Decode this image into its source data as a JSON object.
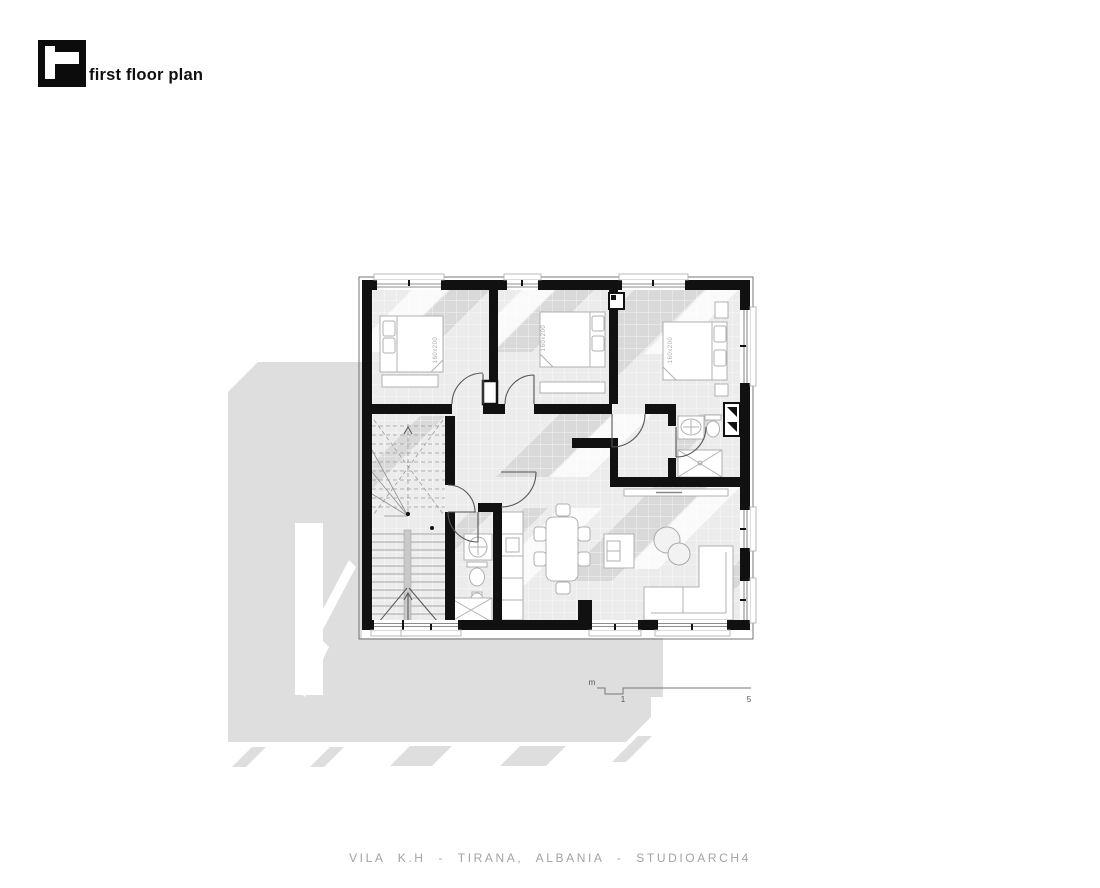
{
  "header": {
    "title": "first floor plan",
    "logo": "studioarch4-logo-icon"
  },
  "plan": {
    "bedroom1_bed_label": "160x200",
    "bedroom2_bed_label": "160x200",
    "bedroom3_bed_label": "160x200"
  },
  "scale_bar": {
    "unit_label": "m",
    "tick_1": "1",
    "tick_2": "5"
  },
  "footer": {
    "caption": "VILA K.H - TIRANA, ALBANIA - STUDIOARCH4"
  },
  "colors": {
    "wall": "#111111",
    "floor": "#ececec",
    "exterior_shadow": "#dedede",
    "interior_shadow": "#d9d9d9",
    "furniture_line": "#b0b0b0",
    "caption_text": "#a3a3a3"
  }
}
